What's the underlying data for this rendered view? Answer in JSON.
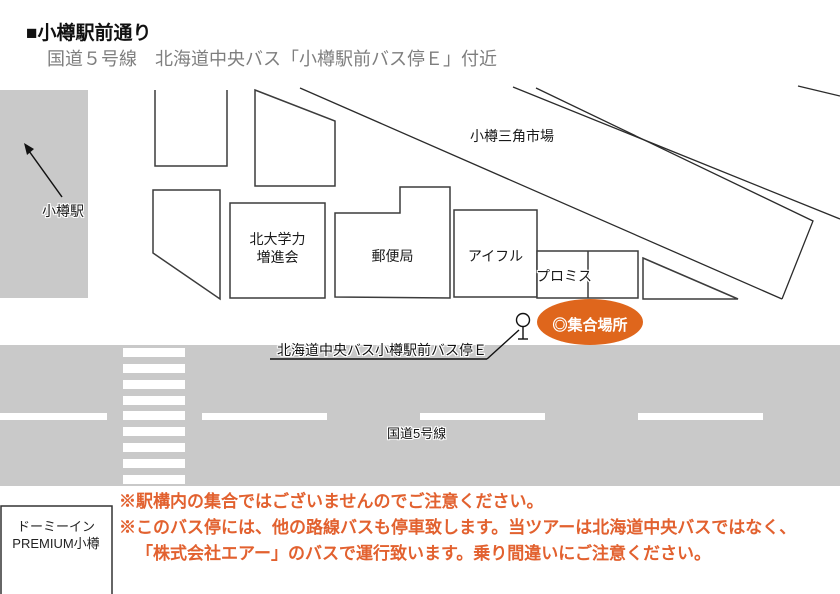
{
  "header": {
    "title": "■小樽駅前通り",
    "subtitle": "国道５号線　北海道中央バス「小樽駅前バス停Ｅ」付近"
  },
  "map": {
    "station": {
      "label": "小樽駅"
    },
    "market": {
      "label": "小樽三角市場"
    },
    "buildings": {
      "cram_school": {
        "line1": "北大学力",
        "line2": "増進会"
      },
      "post_office": {
        "label": "郵便局"
      },
      "aiful": {
        "label": "アイフル"
      },
      "promise": {
        "label": "プロミス"
      }
    },
    "bus_stop": {
      "label": "北海道中央バス小樽駅前バス停Ｅ"
    },
    "meeting_point": {
      "label": "◎集合場所",
      "color": "#DF661C"
    },
    "road": {
      "label": "国道5号線",
      "color": "#C9C9C9"
    },
    "hotel": {
      "line1": "ドーミーイン",
      "line2": "PREMIUM小樽"
    }
  },
  "notes": {
    "color": "#E2612F",
    "line1": "※駅構内の集合ではございませんのでご注意ください。",
    "line2": "※このバス停には、他の路線バスも停車致します。当ツアーは北海道中央バスではなく、",
    "line3": "「株式会社エアー」のバスで運行致います。乗り間違いにご注意ください。"
  }
}
